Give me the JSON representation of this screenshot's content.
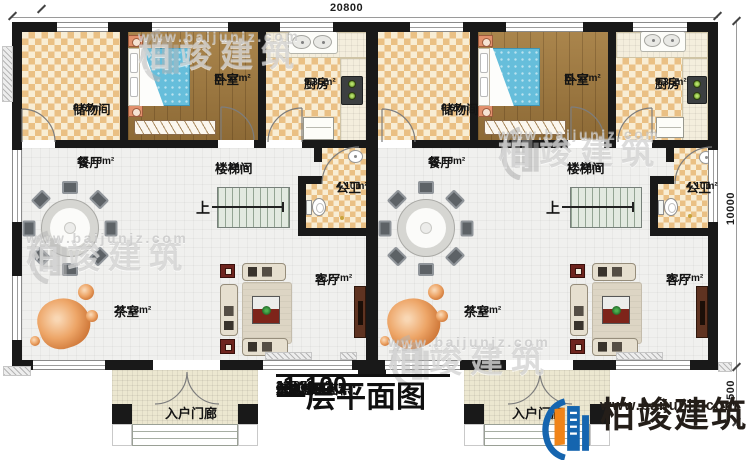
{
  "title_block": {
    "title": "一层平面图",
    "scale": "1:100",
    "stats": [
      {
        "label": "本层建筑面积：",
        "value": "222.88m²"
      },
      {
        "label": "本栋建筑面积：",
        "value": "445.76m²"
      },
      {
        "label": "占地面积：",
        "value": "235.33m²"
      },
      {
        "label": "层高：",
        "value": "4.00m"
      }
    ]
  },
  "brand": {
    "name": "柏竣建筑",
    "site": "www.baijunjz.com"
  },
  "watermark": {
    "name": "柏竣建筑",
    "site": "www.baijunjz.com"
  },
  "dimensions": {
    "top": "20800",
    "right_upper": "10000",
    "right_lower": "1500"
  },
  "rooms": {
    "storage": {
      "name": "储物间",
      "area": "9.67m²"
    },
    "bedroom": {
      "name": "卧室",
      "area": "11.57m²"
    },
    "kitchen": {
      "name": "厨房",
      "area": "9.35m²"
    },
    "dining": {
      "name": "餐厅",
      "area": "10.10m²"
    },
    "stairwell": {
      "name": "楼梯间",
      "area": "11.36m²"
    },
    "bathroom": {
      "name": "公卫",
      "area": "4.10m²"
    },
    "living": {
      "name": "客厅",
      "area": "16.27m²"
    },
    "tea": {
      "name": "茶室",
      "area": "22.13m²"
    },
    "porch": {
      "name": "入户门廊"
    },
    "stair_up": "上"
  },
  "colors": {
    "wall": "#191919",
    "brand_blue": "#1565af",
    "brand_orange": "#f08418",
    "checker_tan": "#eac084",
    "wood_brown": "#a07a41",
    "bed_blue": "#66bedb"
  }
}
